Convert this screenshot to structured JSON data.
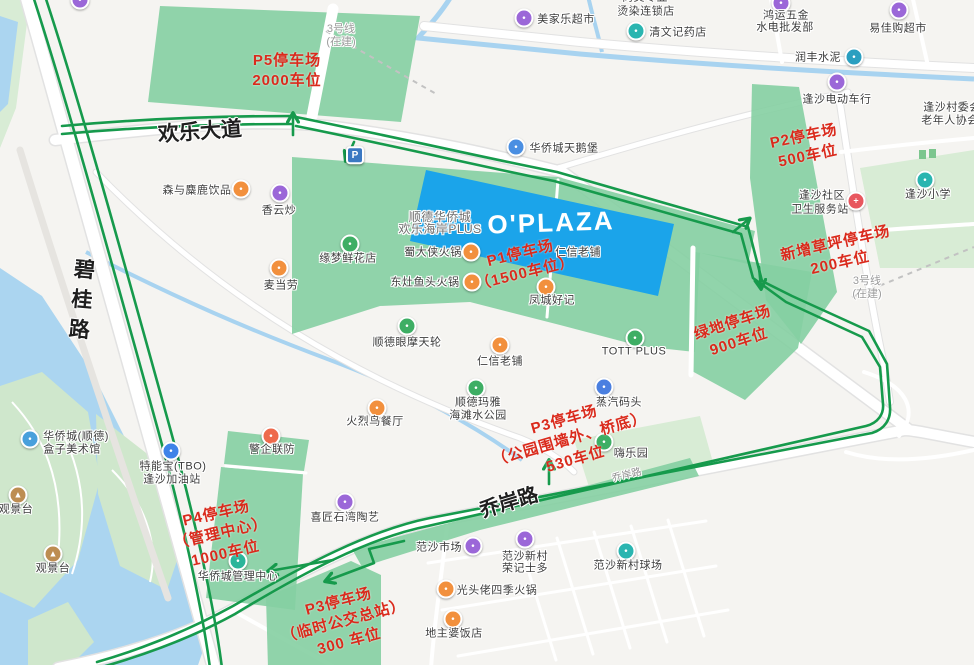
{
  "map": {
    "colors": {
      "zone_green": "#85cfa2",
      "route_green": "#169a4c",
      "annotation_red": "#da2a1c",
      "plaza_blue": "#1ba4ea",
      "water_blue": "#abd5f0",
      "park_green": "#d8ecd5"
    },
    "parking_marker": {
      "label": "P",
      "x": 355,
      "y": 157,
      "color": "#3b78c2"
    },
    "road_labels": [
      {
        "name": "road-label-huanle-avenue",
        "text": "欢乐大道",
        "x": 200,
        "y": 132,
        "rot": -4,
        "size": 21,
        "color": "#1f1f1f",
        "bold": true
      },
      {
        "name": "road-label-bigui-road",
        "text": "碧桂路",
        "x": 80,
        "y": 303,
        "rot": 5,
        "size": 21,
        "color": "#1f1f1f",
        "bold": true,
        "vertical": true
      },
      {
        "name": "road-label-qiaoan-road",
        "text": "乔岸路",
        "x": 509,
        "y": 503,
        "rot": -17,
        "size": 20,
        "color": "#1f1f1f",
        "bold": true
      },
      {
        "name": "road-label-qiaoan-road-small",
        "text": "乔岸路",
        "x": 627,
        "y": 476,
        "rot": -14,
        "size": 10,
        "color": "#8f8f8f"
      },
      {
        "name": "construction-label-line3-north",
        "lines": [
          "3号线",
          "(在建)"
        ],
        "x": 341,
        "y": 36,
        "size": 11,
        "color": "#9b9b9b"
      },
      {
        "name": "construction-label-line3-east",
        "lines": [
          "3号线",
          "(在建)"
        ],
        "x": 867,
        "y": 288,
        "size": 11,
        "color": "#9b9b9b"
      },
      {
        "name": "oplaza-label",
        "text": "O'PLAZA",
        "x": 551,
        "y": 223,
        "rot": -2,
        "size": 26,
        "color": "#ffffff",
        "bold": true,
        "ls": 2,
        "halo": false
      }
    ],
    "annotations": [
      {
        "lines": [
          "P5停车场",
          "2000车位"
        ],
        "x": 287,
        "y": 71,
        "rot": 0
      },
      {
        "lines": [
          "P2停车场",
          "500车位"
        ],
        "x": 806,
        "y": 147,
        "rot": -12
      },
      {
        "lines": [
          "新增草坪停车场",
          "200车位"
        ],
        "x": 838,
        "y": 254,
        "rot": -13
      },
      {
        "lines": [
          "绿地停车场",
          "900车位"
        ],
        "x": 736,
        "y": 333,
        "rot": -18
      },
      {
        "lines": [
          "P1停车场",
          "（1500车位）"
        ],
        "x": 523,
        "y": 264,
        "rot": -14
      },
      {
        "lines": [
          "P3停车场",
          "（公园围墙外、桥底）",
          "530车位"
        ],
        "x": 570,
        "y": 440,
        "rot": -16
      },
      {
        "lines": [
          "P4停车场",
          "（管理中心）",
          "1000车位"
        ],
        "x": 221,
        "y": 534,
        "rot": -13
      },
      {
        "lines": [
          "P3停车场",
          "（临时公交总站）",
          "300 车位"
        ],
        "x": 344,
        "y": 622,
        "rot": -15
      }
    ],
    "pois": [
      {
        "icon": "supermarket-icon",
        "color": "#9b67d8",
        "ix": 524,
        "iy": 19,
        "lines": [
          {
            "t": "美家乐超市",
            "x": 566,
            "y": 20
          }
        ]
      },
      {
        "lines": [
          {
            "t": "尚美专业",
            "x": 645,
            "y": -2
          },
          {
            "t": "烫染连锁店",
            "x": 646,
            "y": 12
          }
        ]
      },
      {
        "icon": "pharmacy-icon",
        "color": "#2ab5b0",
        "ix": 636,
        "iy": 32,
        "lines": [
          {
            "t": "清文记药店",
            "x": 678,
            "y": 33
          }
        ]
      },
      {
        "icon": "hardware-shop-icon",
        "color": "#9b67d8",
        "ix": 781,
        "iy": 4,
        "lines": [
          {
            "t": "鸿运五金",
            "x": 786,
            "y": 16
          },
          {
            "t": "水电批发部",
            "x": 785,
            "y": 28
          }
        ]
      },
      {
        "icon": "supermarket-icon",
        "color": "#9b67d8",
        "ix": 899,
        "iy": 11,
        "lines": [
          {
            "t": "易佳购超市",
            "x": 898,
            "y": 29
          }
        ]
      },
      {
        "icon": "cement-plant-icon",
        "color": "#2a9fc0",
        "ix": 854,
        "iy": 58,
        "lines": [
          {
            "t": "润丰水泥",
            "x": 818,
            "y": 58
          }
        ]
      },
      {
        "icon": "ebike-shop-icon",
        "color": "#9b67d8",
        "ix": 837,
        "iy": 83,
        "lines": [
          {
            "t": "逢沙电动车行",
            "x": 837,
            "y": 100
          }
        ]
      },
      {
        "lines": [
          {
            "t": "逢沙村委会",
            "x": 952,
            "y": 108
          },
          {
            "t": "老年人协会",
            "x": 950,
            "y": 121
          }
        ]
      },
      {
        "icon": "health-station-icon",
        "color": "#e8565e",
        "glyph": "+",
        "ix": 856,
        "iy": 202,
        "lines": [
          {
            "t": "逢沙社区",
            "x": 822,
            "y": 196
          },
          {
            "t": "卫生服务站",
            "x": 820,
            "y": 210
          }
        ]
      },
      {
        "icon": "school-icon",
        "color": "#2ab5b0",
        "ix": 925,
        "iy": 181,
        "lines": [
          {
            "t": "逢沙小学",
            "x": 928,
            "y": 195
          }
        ]
      },
      {
        "icon": "landmark-icon",
        "color": "#4a8fe2",
        "ix": 516,
        "iy": 148,
        "lines": [
          {
            "t": "华侨城天鹅堡",
            "x": 564,
            "y": 149
          }
        ]
      },
      {
        "icon": "drinks-shop-icon",
        "color": "#f2903d",
        "ix": 241,
        "iy": 190,
        "lines": [
          {
            "t": "森与麋鹿饮品",
            "x": 197,
            "y": 191
          }
        ]
      },
      {
        "icon": "restaurant-icon",
        "color": "#9b67d8",
        "ix": 280,
        "iy": 194,
        "lines": [
          {
            "t": "香云炒",
            "x": 279,
            "y": 211
          }
        ]
      },
      {
        "icon": "restaurant-icon",
        "color": "#f2903d",
        "ix": 279,
        "iy": 269,
        "lines": [
          {
            "t": "麦当劳",
            "x": 281,
            "y": 286
          }
        ]
      },
      {
        "place": true,
        "lines": [
          {
            "t": "顺德华侨城",
            "x": 440,
            "y": 217
          },
          {
            "t": "欢乐海岸PLUS",
            "x": 440,
            "y": 229
          }
        ]
      },
      {
        "icon": "flower-shop-icon",
        "color": "#3eae64",
        "ix": 350,
        "iy": 245,
        "lines": [
          {
            "t": "缘梦鲜花店",
            "x": 348,
            "y": 259
          }
        ]
      },
      {
        "icon": "hotpot-icon",
        "color": "#f2903d",
        "ix": 471,
        "iy": 253,
        "lines": [
          {
            "t": "蜀大侠火锅",
            "x": 433,
            "y": 253
          }
        ]
      },
      {
        "icon": "hotpot-icon",
        "color": "#f2903d",
        "ix": 472,
        "iy": 283,
        "lines": [
          {
            "t": "东灶鱼头火锅",
            "x": 425,
            "y": 283
          }
        ]
      },
      {
        "lines": [
          {
            "t": "仁信老铺",
            "x": 578,
            "y": 253
          }
        ]
      },
      {
        "icon": "restaurant-icon",
        "color": "#f2903d",
        "ix": 546,
        "iy": 288,
        "lines": [
          {
            "t": "凤城好记",
            "x": 552,
            "y": 301
          }
        ]
      },
      {
        "icon": "ferris-wheel-icon",
        "color": "#3eae64",
        "ix": 407,
        "iy": 327,
        "lines": [
          {
            "t": "顺德眼摩天轮",
            "x": 407,
            "y": 343
          }
        ]
      },
      {
        "icon": "restaurant-icon",
        "color": "#f2903d",
        "ix": 500,
        "iy": 346,
        "lines": [
          {
            "t": "仁信老铺",
            "x": 500,
            "y": 362
          }
        ]
      },
      {
        "icon": "water-park-icon",
        "color": "#3eae64",
        "ix": 476,
        "iy": 389,
        "lines": [
          {
            "t": "顺德玛雅",
            "x": 478,
            "y": 403
          },
          {
            "t": "海滩水公园",
            "x": 478,
            "y": 416
          }
        ]
      },
      {
        "icon": "restaurant-icon",
        "color": "#f2903d",
        "ix": 377,
        "iy": 409,
        "lines": [
          {
            "t": "火烈鸟餐厅",
            "x": 375,
            "y": 422
          }
        ]
      },
      {
        "icon": "mall-icon",
        "color": "#3eae64",
        "ix": 635,
        "iy": 339,
        "lines": [
          {
            "t": "TOTT PLUS",
            "x": 634,
            "y": 352
          }
        ]
      },
      {
        "icon": "wharf-icon",
        "color": "#4a7fe0",
        "ix": 604,
        "iy": 388,
        "lines": [
          {
            "t": "蒸汽码头",
            "x": 619,
            "y": 403
          }
        ]
      },
      {
        "icon": "playground-icon",
        "color": "#3eae64",
        "ix": 604,
        "iy": 443,
        "lines": [
          {
            "t": "嗨乐园",
            "x": 631,
            "y": 454
          }
        ]
      },
      {
        "icon": "police-icon",
        "color": "#ee6a4c",
        "ix": 271,
        "iy": 437,
        "lines": [
          {
            "t": "警企联防",
            "x": 272,
            "y": 450
          }
        ]
      },
      {
        "icon": "gas-station-icon",
        "color": "#3f83e8",
        "ix": 171,
        "iy": 452,
        "lines": [
          {
            "t": "特能宝(TBO)",
            "x": 173,
            "y": 467
          },
          {
            "t": "逢沙加油站",
            "x": 172,
            "y": 480
          }
        ]
      },
      {
        "icon": "management-center-icon",
        "color": "#2bb59a",
        "ix": 238,
        "iy": 562,
        "lines": [
          {
            "t": "华侨城管理中心",
            "x": 238,
            "y": 577
          }
        ]
      },
      {
        "icon": "ceramics-shop-icon",
        "color": "#9b67d8",
        "ix": 345,
        "iy": 503,
        "lines": [
          {
            "t": "喜匠石湾陶艺",
            "x": 345,
            "y": 518
          }
        ]
      },
      {
        "icon": "museum-icon",
        "color": "#49a0dc",
        "ix": 30,
        "iy": 440,
        "lines": [
          {
            "t": "华侨城(顺德)",
            "x": 76,
            "y": 437
          },
          {
            "t": "盒子美术馆",
            "x": 72,
            "y": 450
          }
        ]
      },
      {
        "icon": "viewpoint-icon",
        "color": "#bd8d52",
        "glyph": "▲",
        "ix": 18,
        "iy": 496,
        "lines": [
          {
            "t": "观景台",
            "x": 16,
            "y": 510
          }
        ]
      },
      {
        "icon": "viewpoint-icon",
        "color": "#bd8d52",
        "glyph": "▲",
        "ix": 53,
        "iy": 555,
        "lines": [
          {
            "t": "观景台",
            "x": 53,
            "y": 569
          }
        ]
      },
      {
        "icon": "market-icon",
        "color": "#9b67d8",
        "ix": 473,
        "iy": 547,
        "lines": [
          {
            "t": "范沙市场",
            "x": 439,
            "y": 548
          }
        ]
      },
      {
        "icon": "shop-icon",
        "color": "#9b67d8",
        "ix": 525,
        "iy": 540,
        "lines": [
          {
            "t": "范沙新村",
            "x": 525,
            "y": 557
          },
          {
            "t": "荣记士多",
            "x": 525,
            "y": 569
          }
        ]
      },
      {
        "icon": "stadium-icon",
        "color": "#2ab5b0",
        "ix": 626,
        "iy": 552,
        "lines": [
          {
            "t": "范沙新村球场",
            "x": 628,
            "y": 566
          }
        ]
      },
      {
        "icon": "hotpot-icon",
        "color": "#f2903d",
        "ix": 446,
        "iy": 590,
        "lines": [
          {
            "t": "光头佬四季火锅",
            "x": 497,
            "y": 591
          }
        ]
      },
      {
        "icon": "restaurant-icon",
        "color": "#f2903d",
        "ix": 453,
        "iy": 620,
        "lines": [
          {
            "t": "地主婆饭店",
            "x": 454,
            "y": 634
          }
        ]
      },
      {
        "icon": "shop-icon",
        "color": "#9b67d8",
        "ix": 80,
        "iy": 1,
        "lines": []
      }
    ]
  }
}
